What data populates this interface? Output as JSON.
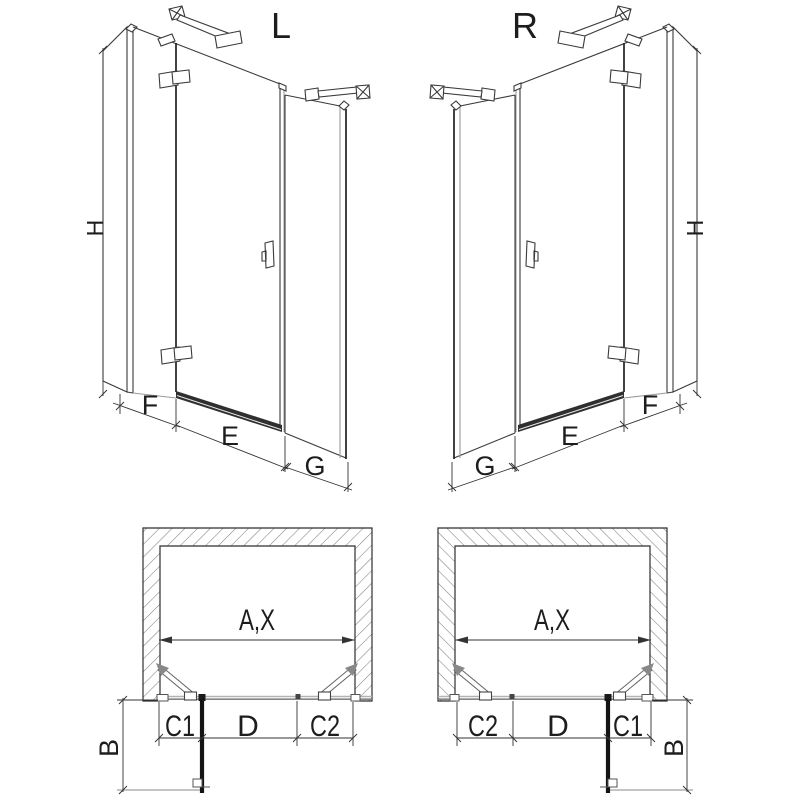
{
  "colors": {
    "line": "#3a3a3a",
    "dimension_line": "#333333",
    "hatch": "#808080",
    "panel_fill": "#141414",
    "background": "#ffffff"
  },
  "perspective_views": {
    "left": {
      "label": "L",
      "dims": {
        "height": "H",
        "wall_panel": "F",
        "door": "E",
        "side_panel": "G"
      }
    },
    "right": {
      "label": "R",
      "dims": {
        "height": "H",
        "wall_panel": "F",
        "door": "E",
        "side_panel": "G"
      }
    }
  },
  "plan_views": {
    "left": {
      "dims": {
        "opening": "A,X",
        "c1": "C1",
        "door": "D",
        "c2": "C2",
        "depth": "B"
      }
    },
    "right": {
      "dims": {
        "opening": "A,X",
        "c2": "C2",
        "door": "D",
        "c1": "C1",
        "depth": "B"
      }
    }
  }
}
